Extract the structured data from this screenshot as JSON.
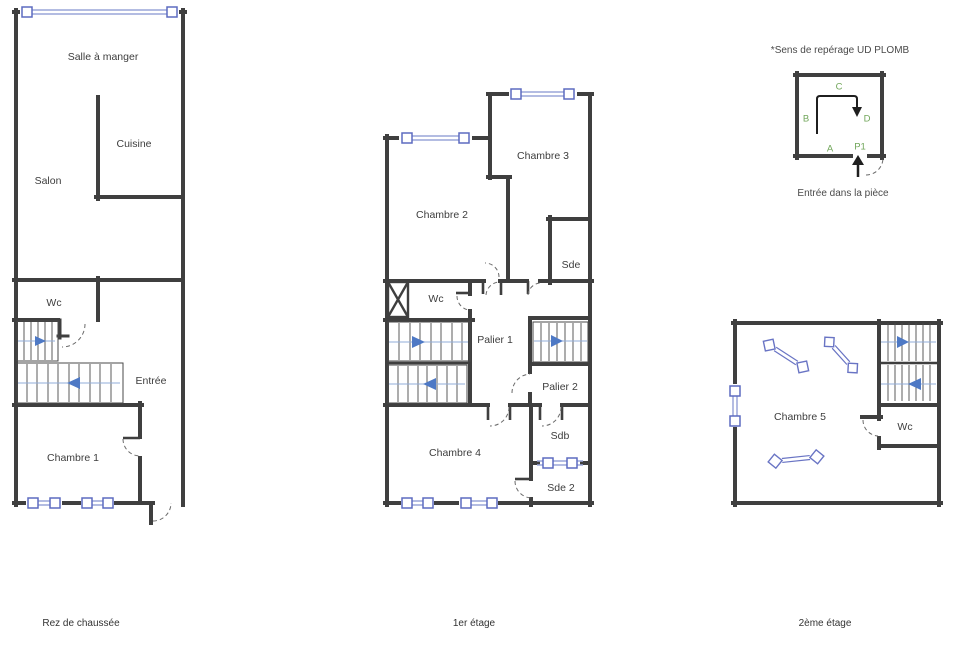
{
  "document": {
    "type": "floor-plans",
    "background": "#ffffff"
  },
  "colors": {
    "wall": "#3f3f3f",
    "window_blue": "#9aa5d9",
    "window_cap_border": "#5d6bc0",
    "stair_flow_blue": "#92add9",
    "stair_arrow_blue": "#4e79c5",
    "skylight_blue": "#6974c4",
    "legend_green": "#71a65a",
    "text": "#3d3d3d"
  },
  "plans": {
    "rdc": {
      "name": "Rez de chaussée",
      "rooms": {
        "salle_a_manger": "Salle à manger",
        "cuisine": "Cuisine",
        "salon": "Salon",
        "wc": "Wc",
        "entree": "Entrée",
        "chambre1": "Chambre 1"
      }
    },
    "etage1": {
      "name": "1er étage",
      "rooms": {
        "chambre2": "Chambre 2",
        "chambre3": "Chambre 3",
        "sde": "Sde",
        "wc": "Wc",
        "palier1": "Palier 1",
        "palier2": "Palier 2",
        "sdb": "Sdb",
        "sde2": "Sde 2",
        "chambre4": "Chambre 4"
      }
    },
    "etage2": {
      "name": "2ème étage",
      "rooms": {
        "chambre5": "Chambre 5",
        "wc": "Wc"
      }
    }
  },
  "legend": {
    "title": "*Sens de repérage UD PLOMB",
    "caption": "Entrée dans la pièce",
    "markers": {
      "a": "A",
      "b": "B",
      "c": "C",
      "d": "D",
      "p1": "P1"
    }
  }
}
